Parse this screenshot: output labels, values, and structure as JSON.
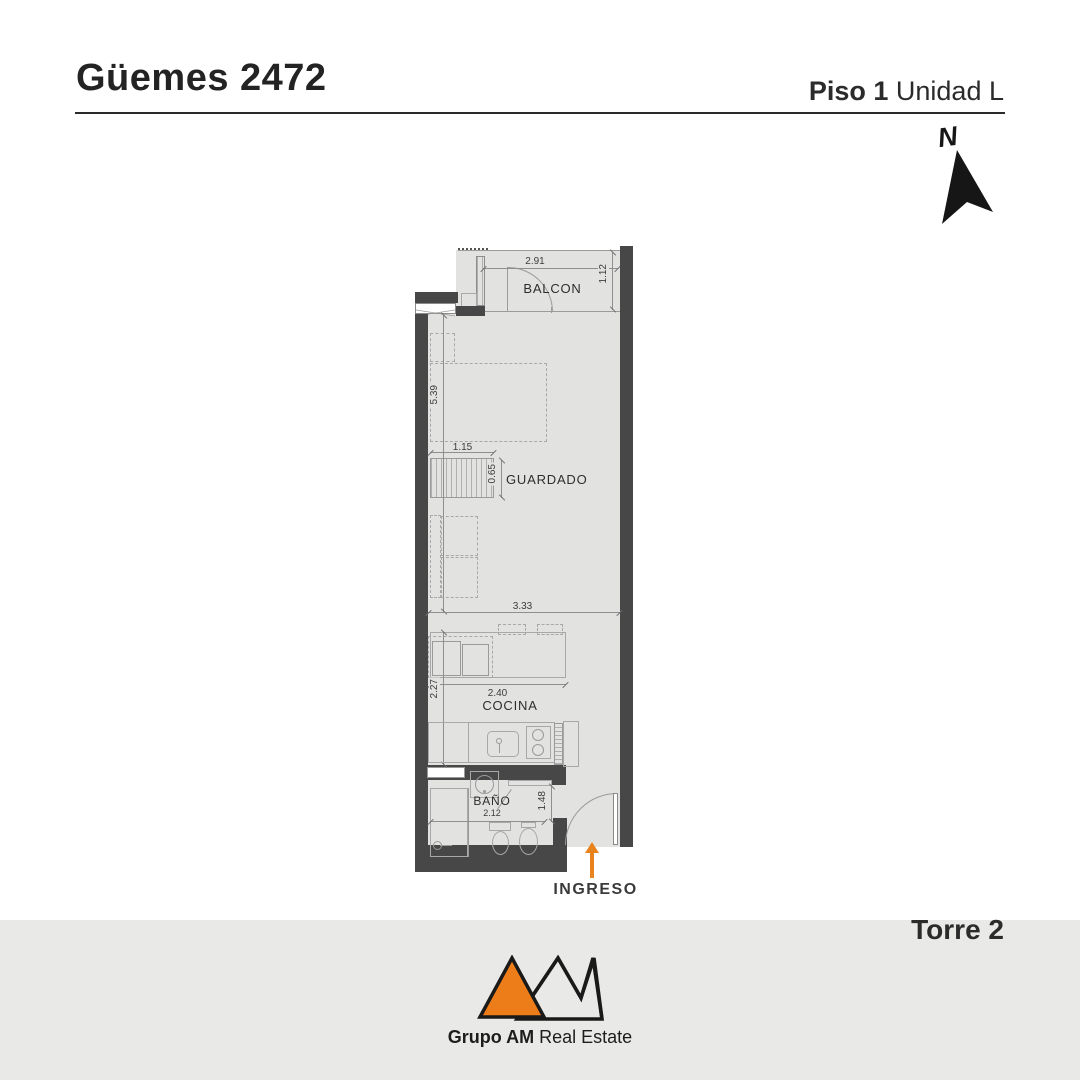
{
  "colors": {
    "accent": "#E8831E",
    "wall": "#474747",
    "floor": "#E2E2E1",
    "footer_band": "#E9E9E7",
    "ink": "#232323"
  },
  "header": {
    "title": "Güemes 2472",
    "floor_label": "Piso 1",
    "unit_label": "Unidad L"
  },
  "compass": {
    "north_label": "N"
  },
  "plan": {
    "rooms": {
      "balcony": "BALCON",
      "storage": "GUARDADO",
      "kitchen": "COCINA",
      "bathroom": "BAÑO"
    },
    "dims": {
      "balcony_width": "2.91",
      "balcony_depth": "1.12",
      "living_length": "5.39",
      "closet_width": "1.15",
      "closet_depth": "0.65",
      "living_width": "3.33",
      "counter_width": "2.40",
      "kitchen_length": "2.27",
      "hall_length": "1.48",
      "bath_width": "2.12"
    },
    "entry_label": "INGRESO"
  },
  "footer": {
    "tower_label": "Torre 2",
    "brand_bold": "Grupo AM",
    "brand_regular": "Real Estate"
  }
}
